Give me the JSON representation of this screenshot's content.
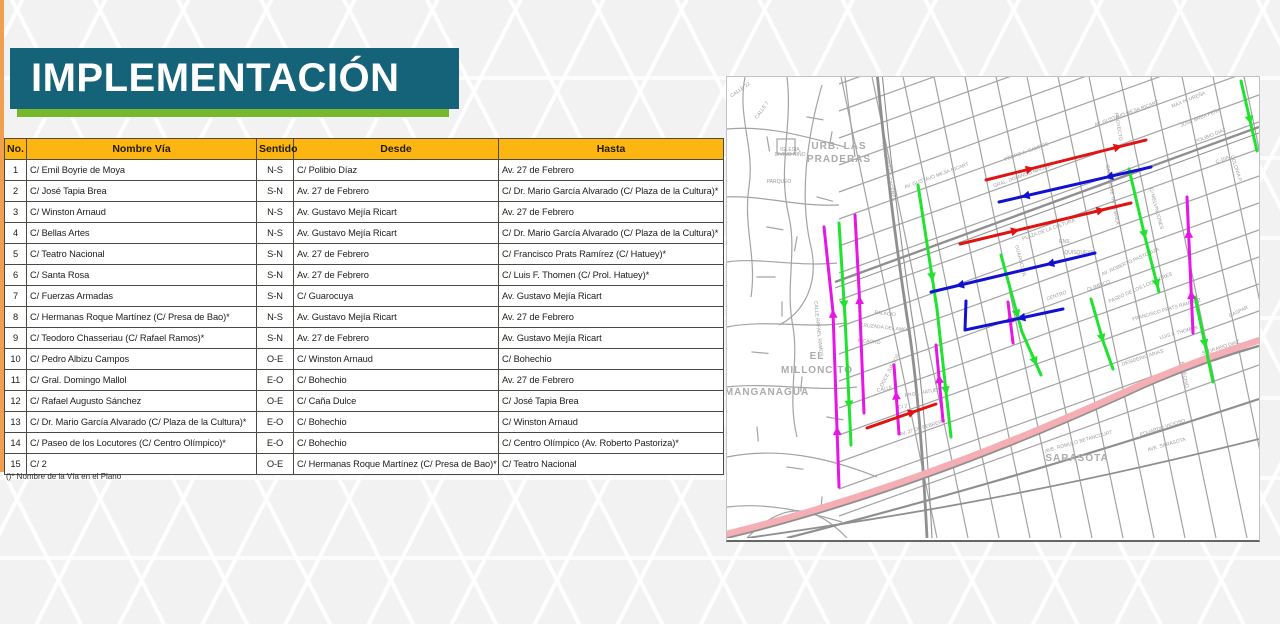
{
  "slide": {
    "title": "IMPLEMENTACIÓN",
    "accent_teal": "#146378",
    "accent_green": "#76b82b",
    "accent_orange": "#f0a04f"
  },
  "table": {
    "headers": [
      "No.",
      "Nombre Vía",
      "Sentido",
      "Desde",
      "Hasta"
    ],
    "rows": [
      [
        "1",
        "C/ Emil Boyrie de Moya",
        "N-S",
        "C/ Polibio Díaz",
        "Av. 27 de Febrero"
      ],
      [
        "2",
        "C/ José Tapia Brea",
        "S-N",
        "Av. 27 de Febrero",
        "C/ Dr. Mario García Alvarado (C/ Plaza de la Cultura)*"
      ],
      [
        "3",
        "C/ Winston Arnaud",
        "N-S",
        "Av. Gustavo Mejía Ricart",
        "Av. 27 de Febrero"
      ],
      [
        "4",
        "C/ Bellas Artes",
        "N-S",
        "Av. Gustavo Mejía Ricart",
        "C/ Dr. Mario García Alvarado (C/ Plaza de la Cultura)*"
      ],
      [
        "5",
        "C/ Teatro Nacional",
        "S-N",
        "Av. 27 de Febrero",
        "C/ Francisco Prats Ramírez (C/ Hatuey)*"
      ],
      [
        "6",
        "C/ Santa Rosa",
        "S-N",
        "Av. 27 de Febrero",
        "C/ Luis F. Thomen (C/ Prol. Hatuey)*"
      ],
      [
        "7",
        "C/ Fuerzas Armadas",
        "S-N",
        "C/ Guarocuya",
        "Av. Gustavo Mejía Ricart"
      ],
      [
        "8",
        "C/ Hermanas Roque Martínez (C/ Presa de Bao)*",
        "N-S",
        "Av. Gustavo Mejía Ricart",
        "Av. 27 de Febrero"
      ],
      [
        "9",
        "C/ Teodoro Chasseriau (C/ Rafael Ramos)*",
        "S-N",
        "Av. 27 de Febrero",
        "Av. Gustavo Mejía Ricart"
      ],
      [
        "10",
        "C/ Pedro Albizu Campos",
        "O-E",
        "C/ Winston Arnaud",
        "C/ Bohechio"
      ],
      [
        "11",
        "C/ Gral. Domingo Mallol",
        "E-O",
        "C/ Bohechio",
        "Av. 27 de Febrero"
      ],
      [
        "12",
        "C/ Rafael Augusto Sánchez",
        "O-E",
        "C/ Caña Dulce",
        "C/ José Tapia Brea"
      ],
      [
        "13",
        "C/ Dr. Mario García Alvarado (C/ Plaza de la Cultura)*",
        "E-O",
        "C/ Bohechio",
        "C/ Winston Arnaud"
      ],
      [
        "14",
        "C/ Paseo de los Locutores (C/ Centro Olímpico)*",
        "E-O",
        "C/ Bohechio",
        "C/ Centro Olímpico (Av. Roberto Pastoriza)*"
      ],
      [
        "15",
        "C/ 2",
        "O-E",
        "C/ Hermanas Roque Martínez (C/ Presa de Bao)*",
        "C/ Teatro Nacional"
      ]
    ],
    "footnote": "()*   Nombre de la Vía en el Plano"
  },
  "map": {
    "highway": {
      "name": "av-27-de-febrero",
      "color": "#f5aeb4",
      "width": 6.5,
      "path": "M -5,458 C 120,428 260,378 400,314 C 460,286 512,270 536,262"
    },
    "route_colors": {
      "green": "#1fe32e",
      "magenta": "#e616e6",
      "red": "#e11212",
      "blue": "#1111cf"
    },
    "routes": [
      {
        "name": "rafael-ramos-magenta",
        "color": "#e616e6",
        "points": [
          [
            97,
            150
          ],
          [
            106,
            235
          ],
          [
            112,
            410
          ]
        ],
        "arrows": [
          0.35,
          0.8
        ],
        "flip": true
      },
      {
        "name": "hermanas-roque-magenta",
        "color": "#e616e6",
        "points": [
          [
            128,
            138
          ],
          [
            132,
            212
          ],
          [
            137,
            336
          ]
        ],
        "arrows": [
          0.45
        ],
        "flip": true
      },
      {
        "name": "left-green",
        "color": "#1fe32e",
        "points": [
          [
            112,
            146
          ],
          [
            118,
            240
          ],
          [
            124,
            368
          ]
        ],
        "arrows": [
          0.35,
          0.8
        ],
        "flip": false
      },
      {
        "name": "bellas-artes-green",
        "color": "#1fe32e",
        "points": [
          [
            191,
            108
          ],
          [
            210,
            232
          ],
          [
            224,
            360
          ]
        ],
        "arrows": [
          0.35,
          0.8
        ],
        "flip": false
      },
      {
        "name": "tapia-brea-green",
        "color": "#1fe32e",
        "points": [
          [
            402,
            92
          ],
          [
            418,
            160
          ],
          [
            432,
            215
          ]
        ],
        "arrows": [
          0.5,
          0.9
        ],
        "flip": false
      },
      {
        "name": "center-green",
        "color": "#1fe32e",
        "points": [
          [
            274,
            178
          ],
          [
            295,
            255
          ],
          [
            314,
            298
          ]
        ],
        "arrows": [
          0.45,
          0.85
        ],
        "flip": false
      },
      {
        "name": "right-green",
        "color": "#1fe32e",
        "points": [
          [
            364,
            222
          ],
          [
            376,
            264
          ],
          [
            386,
            292
          ]
        ],
        "arrows": [
          0.5
        ],
        "flip": false
      },
      {
        "name": "far-right-green",
        "color": "#1fe32e",
        "points": [
          [
            468,
            220
          ],
          [
            486,
            305
          ]
        ],
        "arrows": [
          0.5
        ],
        "flip": false
      },
      {
        "name": "edge-green",
        "color": "#1fe32e",
        "points": [
          [
            514,
            4
          ],
          [
            530,
            74
          ]
        ],
        "arrows": [
          0.5
        ],
        "flip": false
      },
      {
        "name": "santa-rosa-magenta",
        "color": "#e616e6",
        "points": [
          [
            460,
            120
          ],
          [
            466,
            256
          ]
        ],
        "arrows": [
          0.3,
          0.75
        ],
        "flip": true
      },
      {
        "name": "short-magenta-1",
        "color": "#e616e6",
        "points": [
          [
            167,
            288
          ],
          [
            172,
            357
          ]
        ],
        "arrows": [
          0.5
        ],
        "flip": true
      },
      {
        "name": "prol-hatuey-magenta",
        "color": "#e616e6",
        "points": [
          [
            209,
            268
          ],
          [
            216,
            344
          ]
        ],
        "arrows": [
          0.5
        ],
        "flip": true
      },
      {
        "name": "short-magenta-2",
        "color": "#e616e6",
        "points": [
          [
            281,
            225
          ],
          [
            286,
            266
          ]
        ],
        "arrows": [
          0.5
        ],
        "flip": true
      },
      {
        "name": "red-north",
        "color": "#e11212",
        "points": [
          [
            259,
            103
          ],
          [
            419,
            63
          ]
        ],
        "arrows": [
          0.25,
          0.8
        ],
        "flip": false
      },
      {
        "name": "red-mid",
        "color": "#e11212",
        "points": [
          [
            233,
            167
          ],
          [
            404,
            126
          ]
        ],
        "arrows": [
          0.3,
          0.8
        ],
        "flip": false
      },
      {
        "name": "red-c2",
        "color": "#e11212",
        "points": [
          [
            140,
            351
          ],
          [
            209,
            327
          ]
        ],
        "arrows": [
          0.6
        ],
        "flip": false
      },
      {
        "name": "blue-north",
        "color": "#1111cf",
        "points": [
          [
            272,
            125
          ],
          [
            424,
            90
          ]
        ],
        "arrows": [
          0.2,
          0.75
        ],
        "flip": true
      },
      {
        "name": "blue-mid",
        "color": "#1111cf",
        "points": [
          [
            204,
            215
          ],
          [
            368,
            176
          ]
        ],
        "arrows": [
          0.2,
          0.75
        ],
        "flip": true
      },
      {
        "name": "blue-L",
        "color": "#1111cf",
        "points": [
          [
            239,
            224
          ],
          [
            238,
            253
          ],
          [
            336,
            232
          ]
        ],
        "arrows": [
          0.7
        ],
        "flip": true
      }
    ],
    "area_labels": [
      {
        "t": "URB. LAS",
        "x": 112,
        "y": 72
      },
      {
        "t": "PRADERAS",
        "x": 112,
        "y": 85
      },
      {
        "t": "EL",
        "x": 90,
        "y": 282
      },
      {
        "t": "MILLONCITO",
        "x": 90,
        "y": 296
      },
      {
        "t": "MANGANAGUA",
        "x": 40,
        "y": 318
      },
      {
        "t": "SARASOTA",
        "x": 350,
        "y": 384
      }
    ],
    "street_labels": [
      {
        "t": "CALLE 22",
        "x": 14,
        "y": 14,
        "r": -35
      },
      {
        "t": "CALLE 7",
        "x": 36,
        "y": 34,
        "r": -55
      },
      {
        "t": "IGLESIA",
        "x": 63,
        "y": 74,
        "r": 0,
        "s": 4
      },
      {
        "t": "DIVINO NIÑO",
        "x": 63,
        "y": 79,
        "r": 0,
        "s": 4
      },
      {
        "t": "PARQUEO",
        "x": 52,
        "y": 106,
        "r": 0,
        "s": 4.5
      },
      {
        "t": "AV. NUÑEZ DE CACERES",
        "x": 160,
        "y": 95,
        "r": 80
      },
      {
        "t": "AV. GUSTAVO MEJIA RICART",
        "x": 210,
        "y": 100,
        "r": -20
      },
      {
        "t": "AV. GUSTAVO MEJIA RICART",
        "x": 400,
        "y": 38,
        "r": -20
      },
      {
        "t": "PEDRO A. CAMPOS",
        "x": 300,
        "y": 76,
        "r": -20
      },
      {
        "t": "GRAL. DOMINGO MALLOL",
        "x": 296,
        "y": 100,
        "r": -20
      },
      {
        "t": "PROYECTO",
        "x": 390,
        "y": 50,
        "r": 80
      },
      {
        "t": "CALLE JOSE TAPIA BREA",
        "x": 384,
        "y": 118,
        "r": 80
      },
      {
        "t": "C/ MELVIN JONES",
        "x": 428,
        "y": 132,
        "r": 75
      },
      {
        "t": "MAX H. UREÑA",
        "x": 462,
        "y": 24,
        "r": -22
      },
      {
        "t": "JOSE BREA PEÑA",
        "x": 474,
        "y": 42,
        "r": -22
      },
      {
        "t": "POLIBIO DIAZ",
        "x": 484,
        "y": 60,
        "r": -22
      },
      {
        "t": "C-10A",
        "x": 496,
        "y": 84,
        "r": -22
      },
      {
        "t": "COLONIA P.",
        "x": 508,
        "y": 92,
        "r": 72
      },
      {
        "t": "PLAZA DE LA CULTURA",
        "x": 322,
        "y": 154,
        "r": -20
      },
      {
        "t": "ENS.",
        "x": 338,
        "y": 166,
        "r": 0,
        "s": 8
      },
      {
        "t": "QUISQUEYA",
        "x": 352,
        "y": 177,
        "r": 0,
        "s": 8
      },
      {
        "t": "GUAROCUYA",
        "x": 292,
        "y": 184,
        "r": 76
      },
      {
        "t": "CENTRO",
        "x": 330,
        "y": 220,
        "r": -20
      },
      {
        "t": "OLIMPICO",
        "x": 372,
        "y": 210,
        "r": -20
      },
      {
        "t": "AV. ROBERTO PASTORIZA",
        "x": 404,
        "y": 186,
        "r": -24
      },
      {
        "t": "PASEO DE LOS LOCUTORES",
        "x": 414,
        "y": 212,
        "r": -24
      },
      {
        "t": "FRANCISCO PRATS RAMIREZ",
        "x": 440,
        "y": 234,
        "r": -16
      },
      {
        "t": "LUIS F. THOMEN",
        "x": 452,
        "y": 257,
        "r": -16
      },
      {
        "t": "GASPAR",
        "x": 512,
        "y": 236,
        "r": -26
      },
      {
        "t": "SAGRARIO DIAZ",
        "x": 494,
        "y": 272,
        "r": -18
      },
      {
        "t": "DESIDERIO ARIAS",
        "x": 416,
        "y": 282,
        "r": -18
      },
      {
        "t": "BOHECHIO",
        "x": 456,
        "y": 298,
        "r": 78
      },
      {
        "t": "EDUARDO VICIOSO",
        "x": 436,
        "y": 352,
        "r": -18
      },
      {
        "t": "AVE. SARASOTA",
        "x": 440,
        "y": 369,
        "r": -16
      },
      {
        "t": "AVE. ROMULO BETANCOURT",
        "x": 352,
        "y": 366,
        "r": -16
      },
      {
        "t": "CALLE RAFAEL RAMOS",
        "x": 90,
        "y": 252,
        "r": 84
      },
      {
        "t": "PALACIO",
        "x": 158,
        "y": 238,
        "r": 6
      },
      {
        "t": "CRUZADA DEL AMOR",
        "x": 158,
        "y": 252,
        "r": 6
      },
      {
        "t": "PICACHO",
        "x": 142,
        "y": 266,
        "r": 6
      },
      {
        "t": "DOCE JUEGOS",
        "x": 164,
        "y": 294,
        "r": -62
      },
      {
        "t": "CALLE 4",
        "x": 160,
        "y": 313,
        "r": -10
      },
      {
        "t": "PROL. HATUEY",
        "x": 196,
        "y": 317,
        "r": -10
      },
      {
        "t": "C/ 2",
        "x": 176,
        "y": 331,
        "r": -10
      },
      {
        "t": "AV. 27 DE FEBRERO",
        "x": 196,
        "y": 352,
        "r": -17
      }
    ]
  }
}
